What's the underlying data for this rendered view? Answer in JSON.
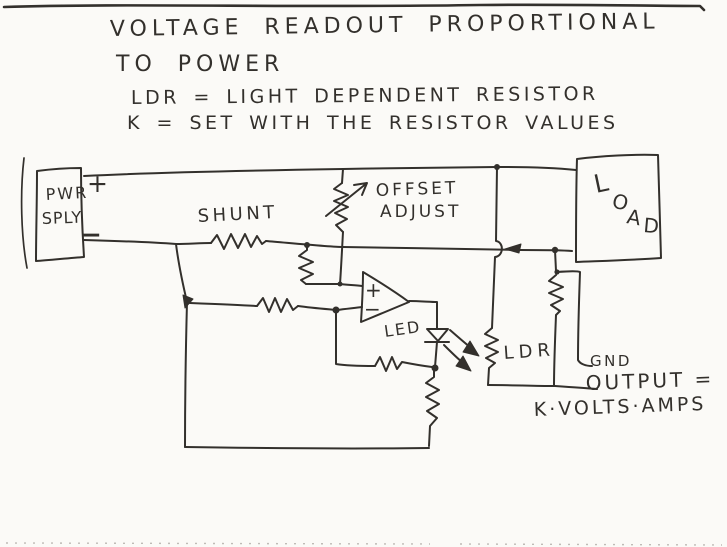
{
  "colors": {
    "ink": "#33302c",
    "paper": "#fbfaf7"
  },
  "notes": {
    "title_line1": "VOLTAGE READOUT PROPORTIONAL",
    "title_line2": "TO POWER",
    "definition_ldr": "LDR = LIGHT DEPENDENT RESISTOR",
    "definition_k": "K = SET WITH THE RESISTOR VALUES"
  },
  "components": {
    "power_supply": {
      "line1": "PWR",
      "line2": "SPLY",
      "plus": "+",
      "minus": "−"
    },
    "shunt": {
      "label": "SHUNT"
    },
    "offset_adjust": {
      "line1": "OFFSET",
      "line2": "ADJUST"
    },
    "load": {
      "label": "LOAD",
      "letters": [
        "L",
        "O",
        "A",
        "D"
      ]
    },
    "opamp": {
      "plus_input": "+",
      "minus_input": "−"
    },
    "led": {
      "label": "LED"
    },
    "ldr": {
      "label": "LDR"
    },
    "gnd": {
      "label": "GND"
    }
  },
  "output": {
    "label": "OUTPUT =",
    "formula": "K·VOLTS·AMPS"
  }
}
